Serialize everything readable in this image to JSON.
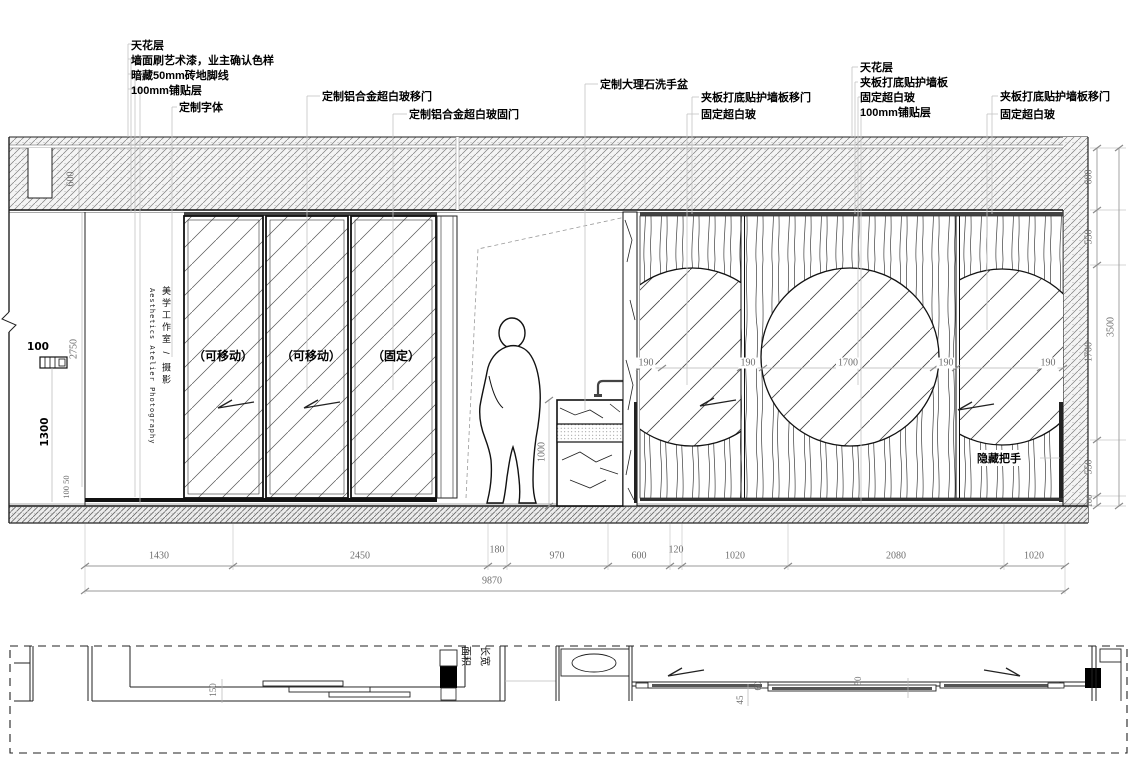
{
  "ann": {
    "g1": [
      "天花层",
      "墙面刷艺术漆，业主确认色样",
      "暗藏50mm砖地脚线",
      "100mm铺贴层",
      "定制字体"
    ],
    "g2": [
      "定制铝合金超白玻移门",
      "定制铝合金超白玻固门"
    ],
    "g3": [
      "定制大理石洗手盆"
    ],
    "g4": [
      "夹板打底贴护墙板移门",
      "固定超白玻"
    ],
    "g5": [
      "天花层",
      "夹板打底贴护墙板",
      "固定超白玻",
      "100mm铺贴层"
    ],
    "g6": [
      "夹板打底贴护墙板移门",
      "固定超白玻"
    ]
  },
  "panels": {
    "p1": "（可移动）",
    "p2": "（可移动）",
    "p3": "（固定）",
    "handle": "隐藏把手"
  },
  "studio": {
    "cn": "美学工作室 / 摄影",
    "en": "Aesthetics Atelier Photography"
  },
  "dims": {
    "bottom": [
      "1430",
      "2450",
      "180",
      "970",
      "600",
      "120",
      "1020",
      "2080",
      "1020"
    ],
    "total": "9870",
    "left_ceiling": "600",
    "left_wall": "2750",
    "sign_w": "100",
    "sign_h": "1300",
    "left_base": "100 50",
    "basin": "1000",
    "wood": [
      "190",
      "190",
      "1700",
      "190",
      "190"
    ],
    "right": [
      "600",
      "550",
      "1700",
      "550",
      "100"
    ],
    "right_total": "3500",
    "plan": [
      "150",
      "45",
      "60",
      "50"
    ]
  },
  "plan": {
    "label1": "面积",
    "label2": "长宽"
  },
  "colors": {
    "line": "#1a1a1a",
    "dim_text": "#6e6e6e",
    "leader": "#c3c3c3",
    "hatch": "#6a6a6a"
  }
}
